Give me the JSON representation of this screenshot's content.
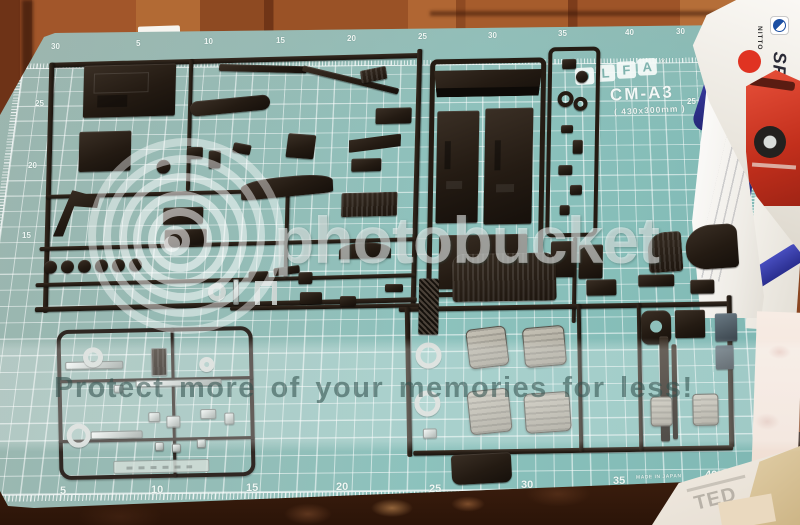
{
  "watermark": {
    "wordmark": "photobucket",
    "banner_text": "Protect more of your memories for less!",
    "logo": "photobucket-rings-logo"
  },
  "mat": {
    "brand_letters": [
      "O",
      "L",
      "F",
      "A"
    ],
    "registered_mark": "®",
    "model": "CM-A3",
    "size_label": "( 430x300mm )",
    "made_in": "MADE IN JAPAN",
    "ruler": {
      "top": [
        "30",
        "5",
        "10",
        "15",
        "20",
        "25",
        "30",
        "35",
        "40",
        "30"
      ],
      "left": [
        "25",
        "20",
        "15"
      ],
      "right": [
        "25",
        "20"
      ],
      "bottom": [
        "5",
        "10",
        "15",
        "20",
        "25",
        "30",
        "35",
        "40"
      ]
    }
  },
  "box": {
    "brand": "NITTO",
    "model": "SR311"
  },
  "background_paper_text": "TED",
  "colors": {
    "mat_teal": "#8dc2bd",
    "sprue_dark": "#241b13",
    "chrome_silver": "#d9dedb",
    "seat_gray": "#b0aca2",
    "box_red": "#d63a24",
    "logo_blue": "#1b4fa3",
    "wood_brown": "#9a5226"
  }
}
